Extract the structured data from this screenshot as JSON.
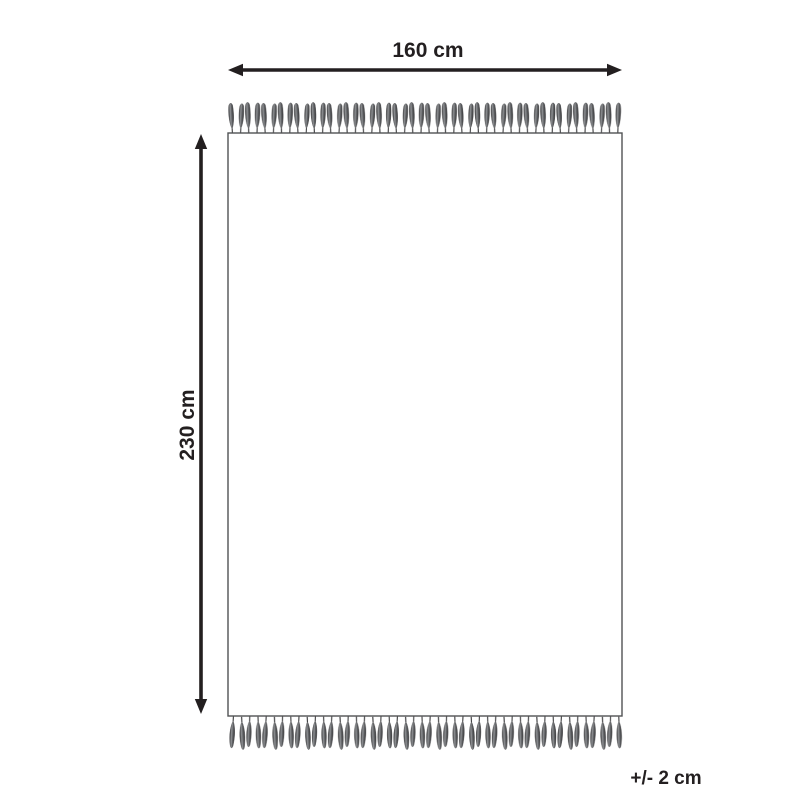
{
  "diagram": {
    "width_label": "160 cm",
    "height_label": "230 cm",
    "tolerance_label": "+/- 2 cm",
    "measurements": {
      "width_cm": 160,
      "height_cm": 230,
      "tolerance_cm": 2
    },
    "colors": {
      "background": "#ffffff",
      "line": "#231f20",
      "rug_outline": "#515254",
      "fringe_dark": "#3b3b3d",
      "fringe_mid": "#939598",
      "fringe_shadow": "#66686b"
    }
  }
}
